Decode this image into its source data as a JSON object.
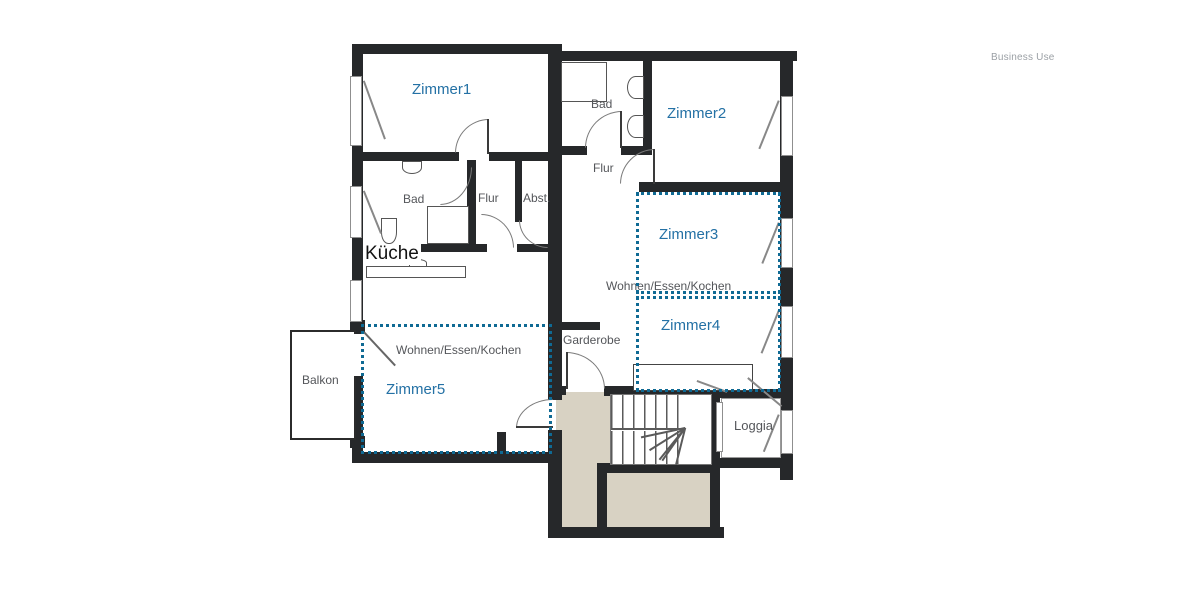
{
  "watermark": "Business Use",
  "plan": {
    "rooms": {
      "zimmer1": "Zimmer1",
      "zimmer2": "Zimmer2",
      "zimmer3": "Zimmer3",
      "zimmer4": "Zimmer4",
      "zimmer5": "Zimmer5",
      "bad_left": "Bad",
      "flur_left": "Flur",
      "abst": "Abst.",
      "bad_right": "Bad",
      "flur_right": "Flur",
      "kueche": "Küche",
      "wohnen_left": "Wohnen/Essen/Kochen",
      "wohnen_right": "Wohnen/Essen/Kochen",
      "garderobe": "Garderobe",
      "balkon": "Balkon",
      "loggia": "Loggia"
    },
    "colors": {
      "room_label_blue": "#2471a5",
      "annotation_dotted": "#0f6a94",
      "plan_label_gray": "#54565a",
      "wall": "#26282a",
      "stairwell_fill": "#d8d2c3",
      "watermark_gray": "#9ba0a5"
    }
  }
}
